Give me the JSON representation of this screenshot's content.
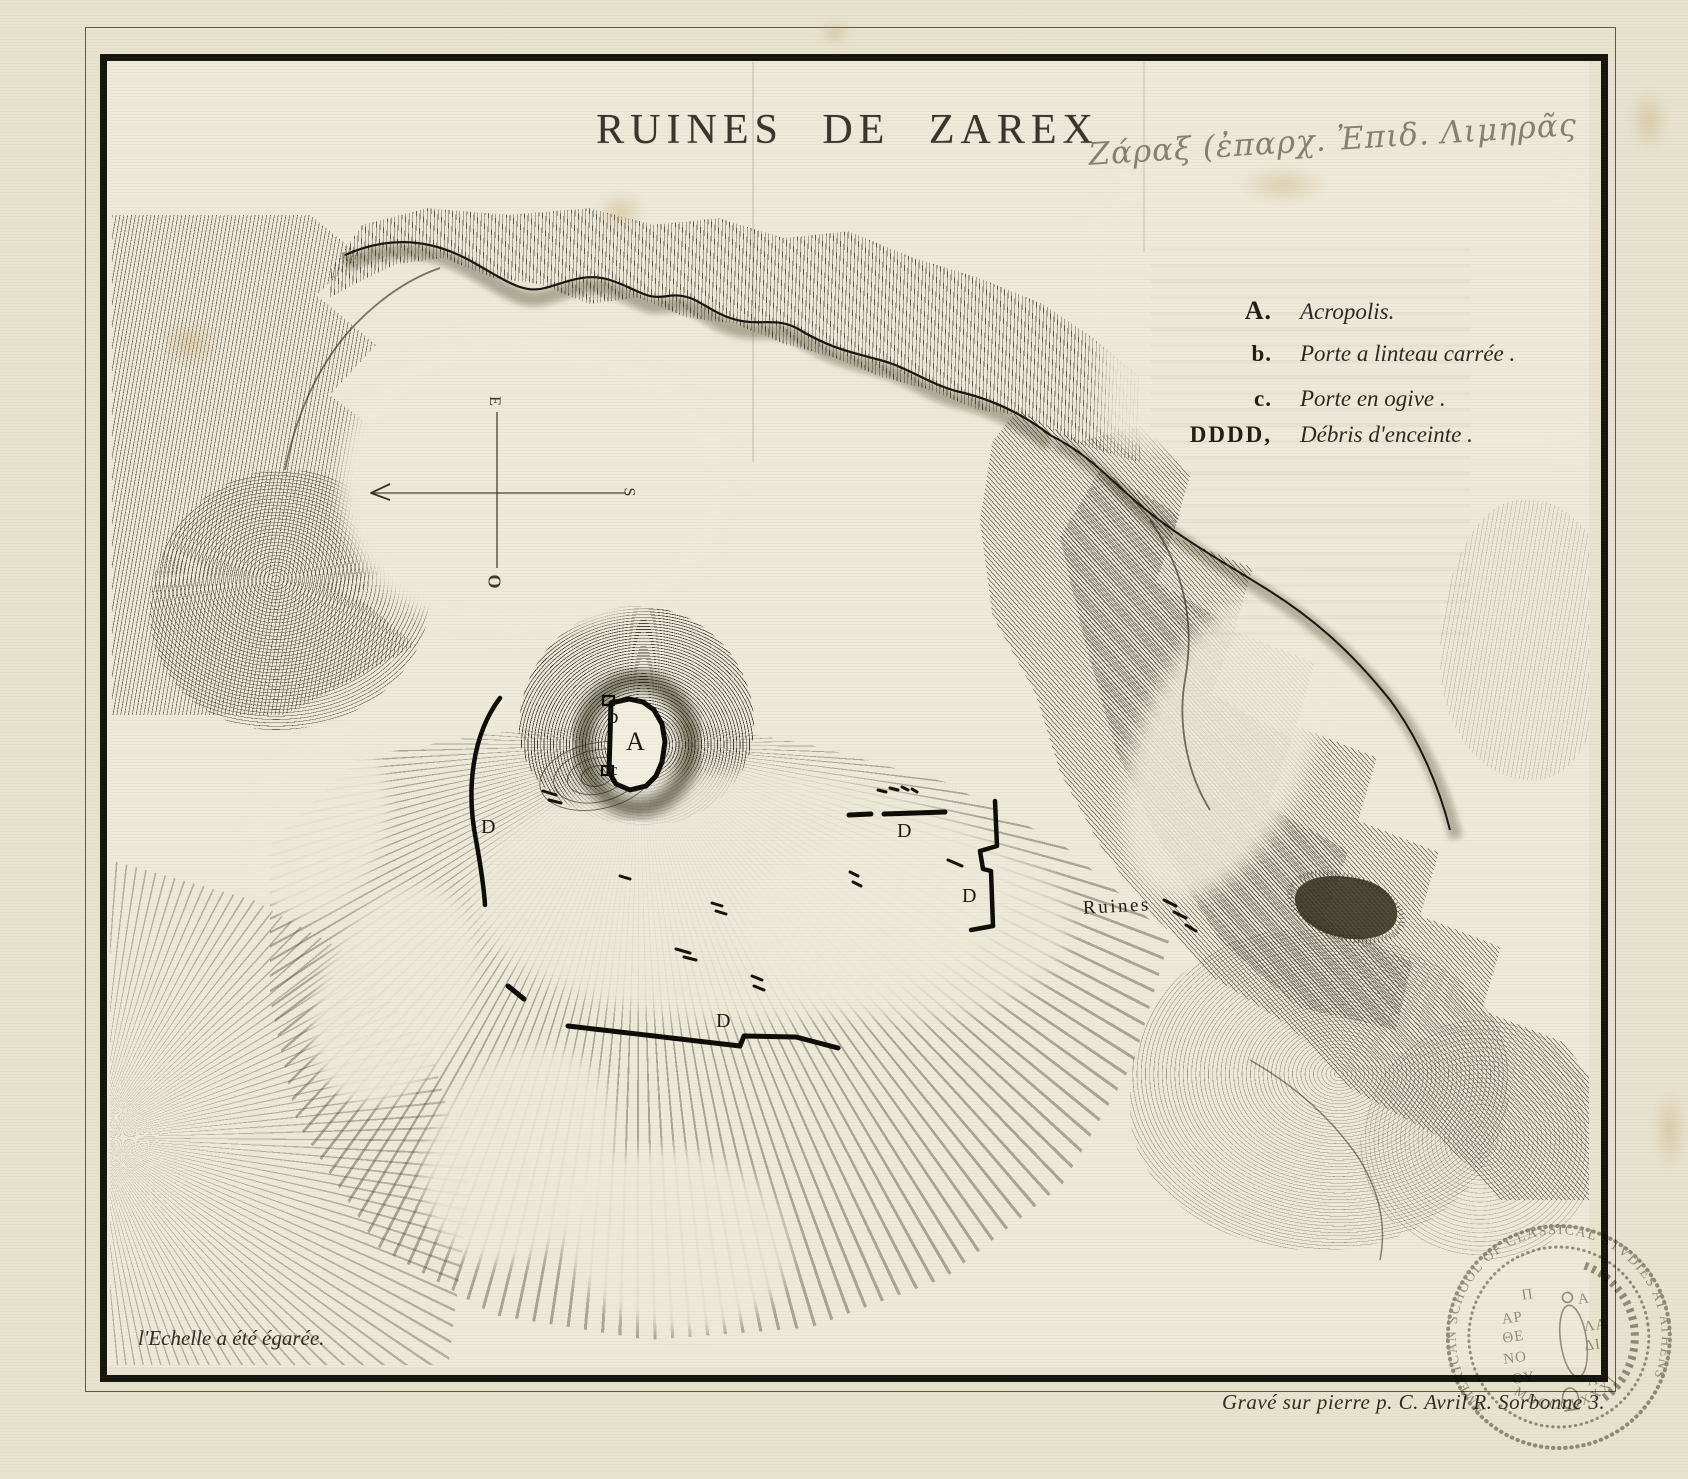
{
  "sheet": {
    "title": "RUINES DE ZAREX",
    "handwritten_annotation": "Ζάραξ (ἐπαρχ. Ἐπιδ. Λιμηρᾶς",
    "scale_note": "l'Echelle a été égarée.",
    "engraver_credit": "Gravé sur pierre p. C. Avril R. Sorbonne 3."
  },
  "legend": {
    "items": [
      {
        "key": "A.",
        "label": "Acropolis."
      },
      {
        "key": "b.",
        "label": "Porte a linteau carrée ."
      },
      {
        "key": "c.",
        "label": "Porte en ogive ."
      },
      {
        "key": "DDDD,",
        "label": "Débris d'enceinte ."
      }
    ]
  },
  "compass": {
    "east": "E",
    "south": "S",
    "west": "O"
  },
  "labels": {
    "acropolis": "A",
    "gate_b": "b",
    "gate_c": "c",
    "wall_d": "D",
    "ruins": "Ruines"
  },
  "stamp": {
    "rim_text": "AMERICAN SCHOOL OF CLASSICAL STVDIES AT ATHENS",
    "year": "MDCCCLXXXI",
    "inner_left_glyphs": [
      "Π",
      "ΑΡ",
      "ΘΕ",
      "ΝΟ",
      "ΟΥ"
    ],
    "inner_right_glyphs": [
      "Α",
      "ΛΑ",
      "ΔΙ",
      "Α"
    ]
  },
  "colors": {
    "paper": "#e8e3cf",
    "map_paper": "#edead9",
    "ink": "#1a170f",
    "pencil": "#85816f",
    "stamp": "#8e897c"
  }
}
